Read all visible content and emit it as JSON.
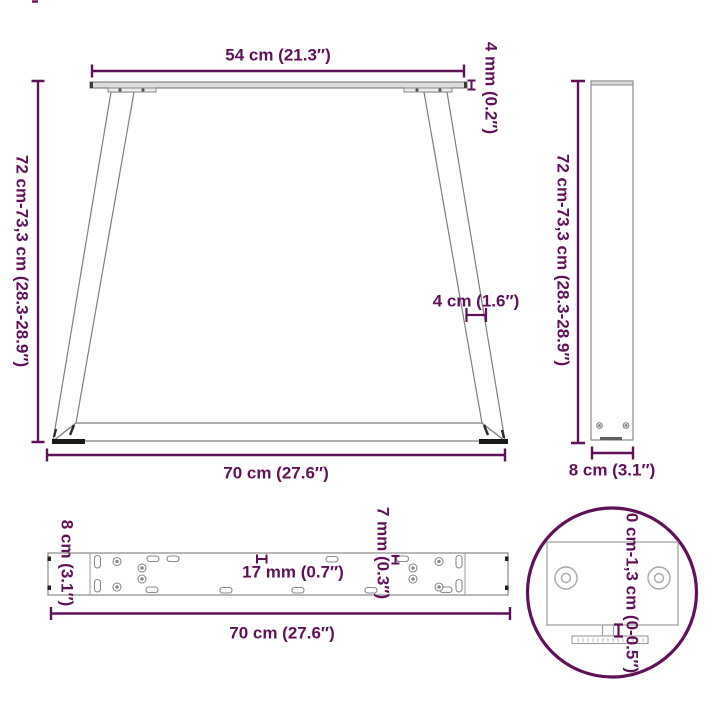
{
  "diagram": {
    "accent_color": "#5f1257",
    "title": "table-leg-dimension-diagram",
    "labels": {
      "front_top_width": "54 cm (21.3″)",
      "front_plate_thickness": "4 mm (0.2″)",
      "front_height": "72 cm-73,3 cm (28.3-28.9″)",
      "front_leg_width": "4 cm (1.6″)",
      "front_bottom_width": "70 cm (27.6″)",
      "side_height": "72 cm-73,3 cm (28.3-28.9″)",
      "side_depth": "8 cm (3.1″)",
      "plate_depth": "8 cm (3.1″)",
      "plate_slot_length": "17 mm (0.7″)",
      "plate_slot_width": "7 mm (0.3″)",
      "plate_length": "70 cm (27.6″)",
      "foot_adjustable_height": "0 cm-1,3 cm (0-0.5″)"
    }
  }
}
